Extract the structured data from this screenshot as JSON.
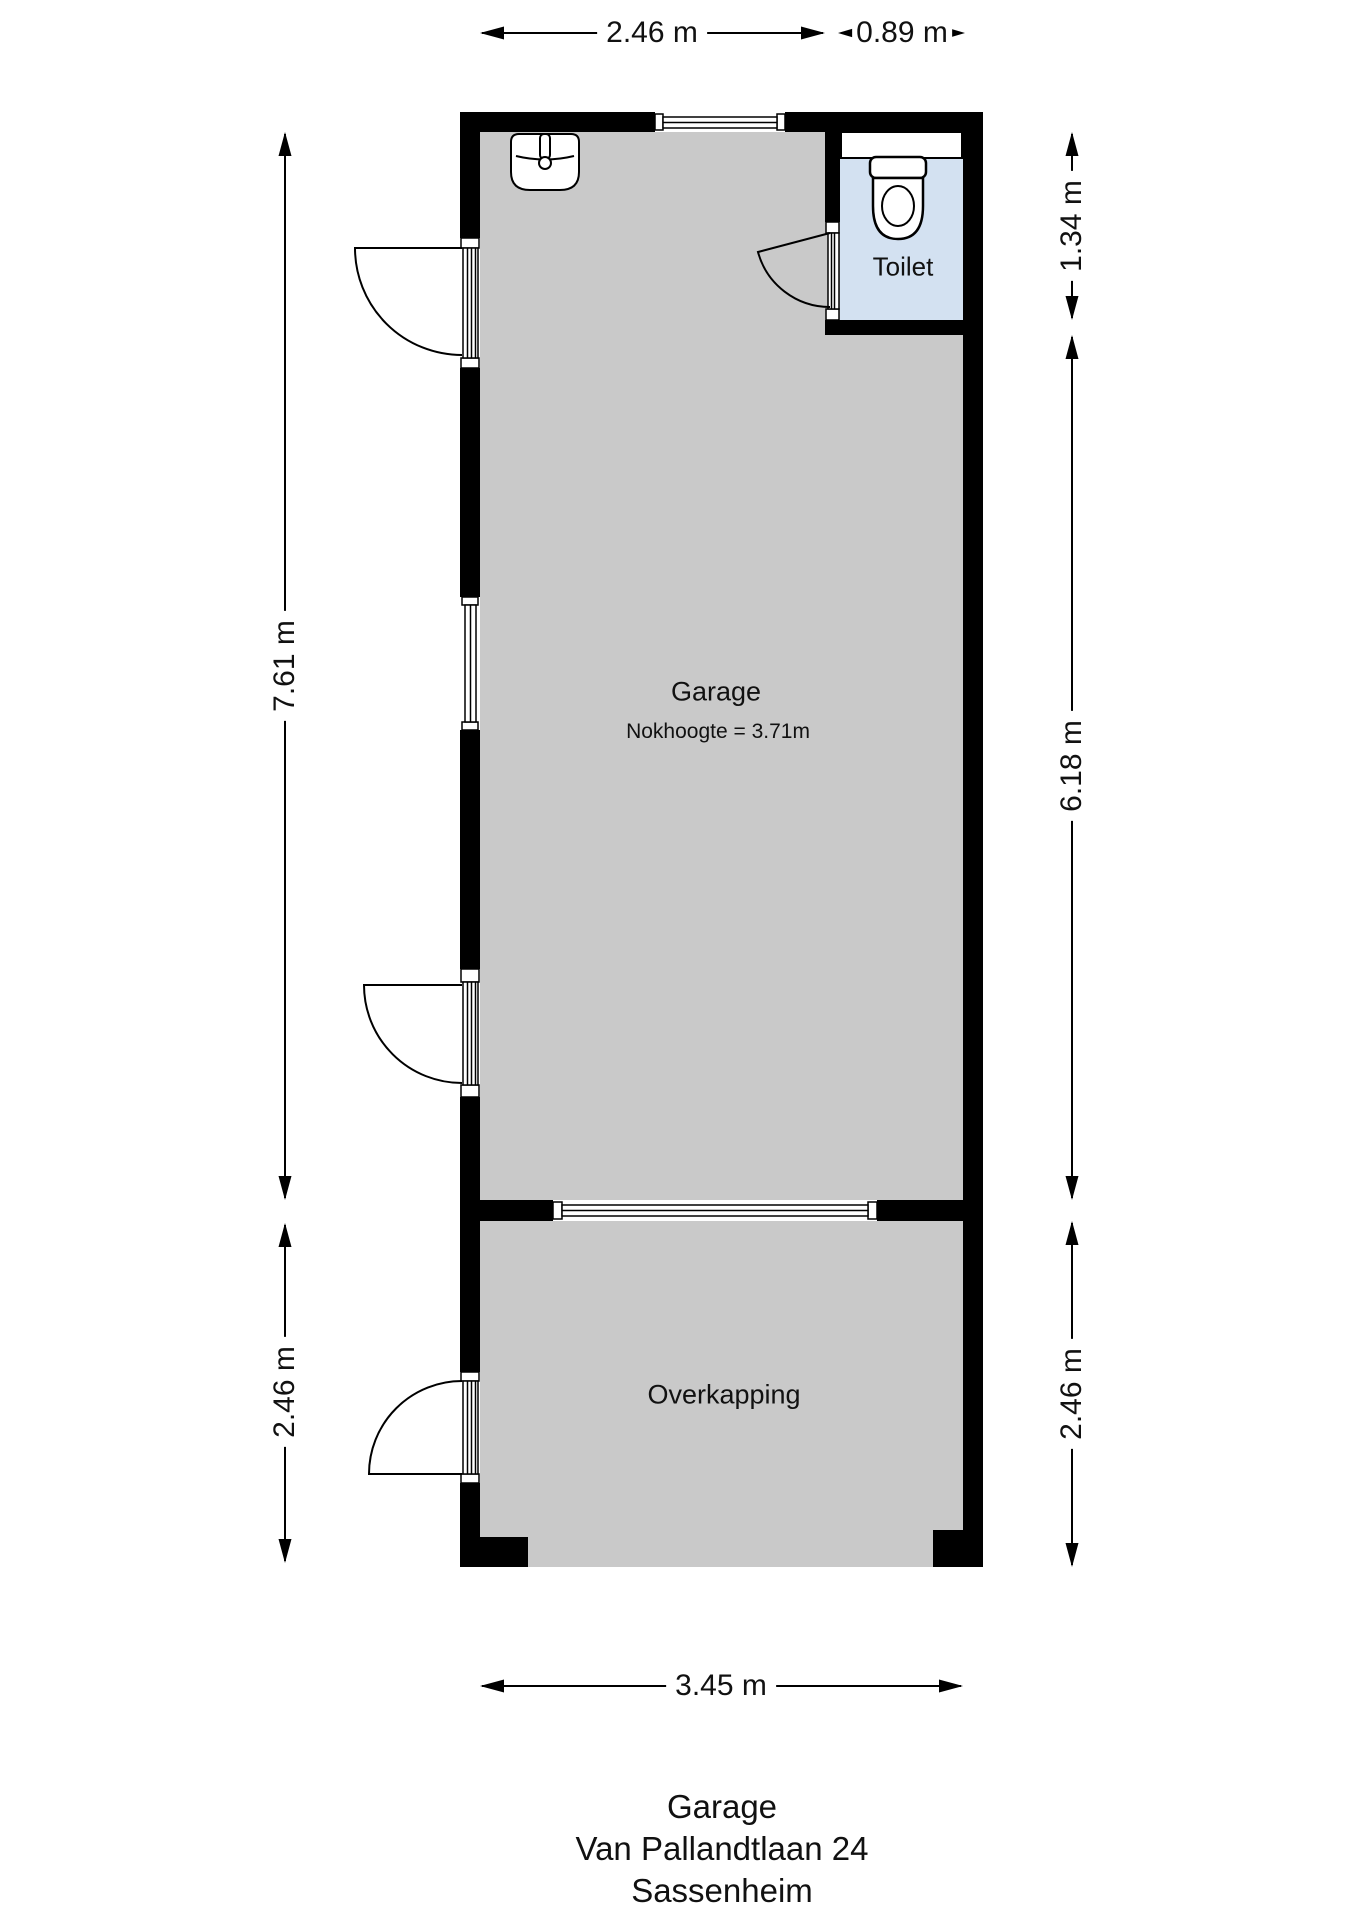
{
  "document": {
    "type": "floorplan"
  },
  "rooms": {
    "garage": {
      "label": "Garage",
      "note": "Nokhoogte = 3.71m"
    },
    "toilet": {
      "label": "Toilet"
    },
    "overkapping": {
      "label": "Overkapping"
    }
  },
  "dimensions": {
    "top_garage_width": "2.46 m",
    "top_toilet_width": "0.89 m",
    "right_toilet_height": "1.34 m",
    "right_garage_height": "6.18 m",
    "right_overkapping_height": "2.46 m",
    "left_garage_height": "7.61 m",
    "left_overkapping_height": "2.46 m",
    "bottom_width": "3.45 m"
  },
  "title": {
    "line1": "Garage",
    "line2": "Van Pallandtlaan 24",
    "line3": "Sassenheim"
  },
  "icons": {
    "sink": "sink-icon",
    "toilet": "toilet-icon"
  },
  "colors": {
    "wall": "#000000",
    "garage_floor": "#c9c9c9",
    "toilet_floor": "#d3e1f1",
    "background": "#ffffff",
    "text": "#111111"
  }
}
